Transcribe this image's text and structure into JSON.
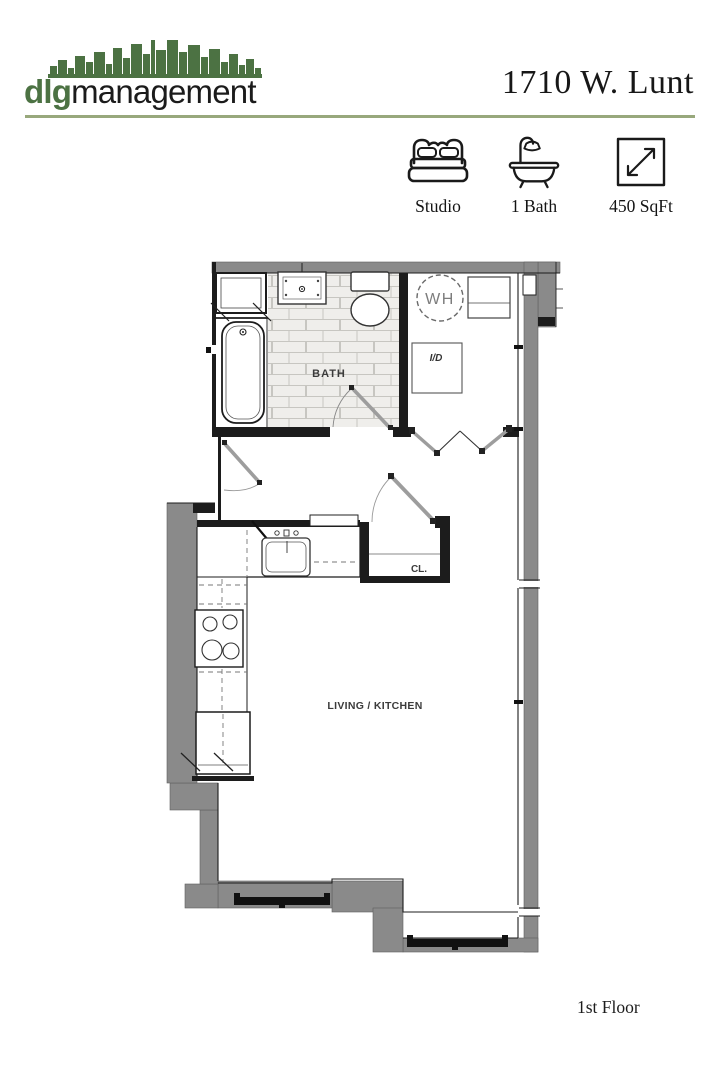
{
  "brand": {
    "logo_bold": "dlg",
    "logo_regular": "management",
    "logo_green": "#4c7243",
    "divider_green": "#98a87c"
  },
  "header": {
    "title": "1710 W. Lunt"
  },
  "unit_stats": [
    {
      "icon": "bed-icon",
      "label": "Studio"
    },
    {
      "icon": "bathtub-icon",
      "label": "1 Bath"
    },
    {
      "icon": "area-arrows-icon",
      "label": "450 SqFt"
    }
  ],
  "floor_plan": {
    "wall_color": "#8a8a8a",
    "labels": {
      "bath": "BATH",
      "water_heater": "WH",
      "washer_dryer": "I/D",
      "closet": "CL.",
      "living_kitchen": "LIVING / KITCHEN"
    },
    "fixtures": [
      "bathtub",
      "bathroom-sink",
      "toilet",
      "linen-closet",
      "water-heater",
      "washer-dryer-hookup",
      "utility-cabinet",
      "kitchen-sink",
      "range",
      "refrigerator",
      "entry-closet",
      "windows"
    ]
  },
  "footer": {
    "floor_label": "1st Floor"
  }
}
